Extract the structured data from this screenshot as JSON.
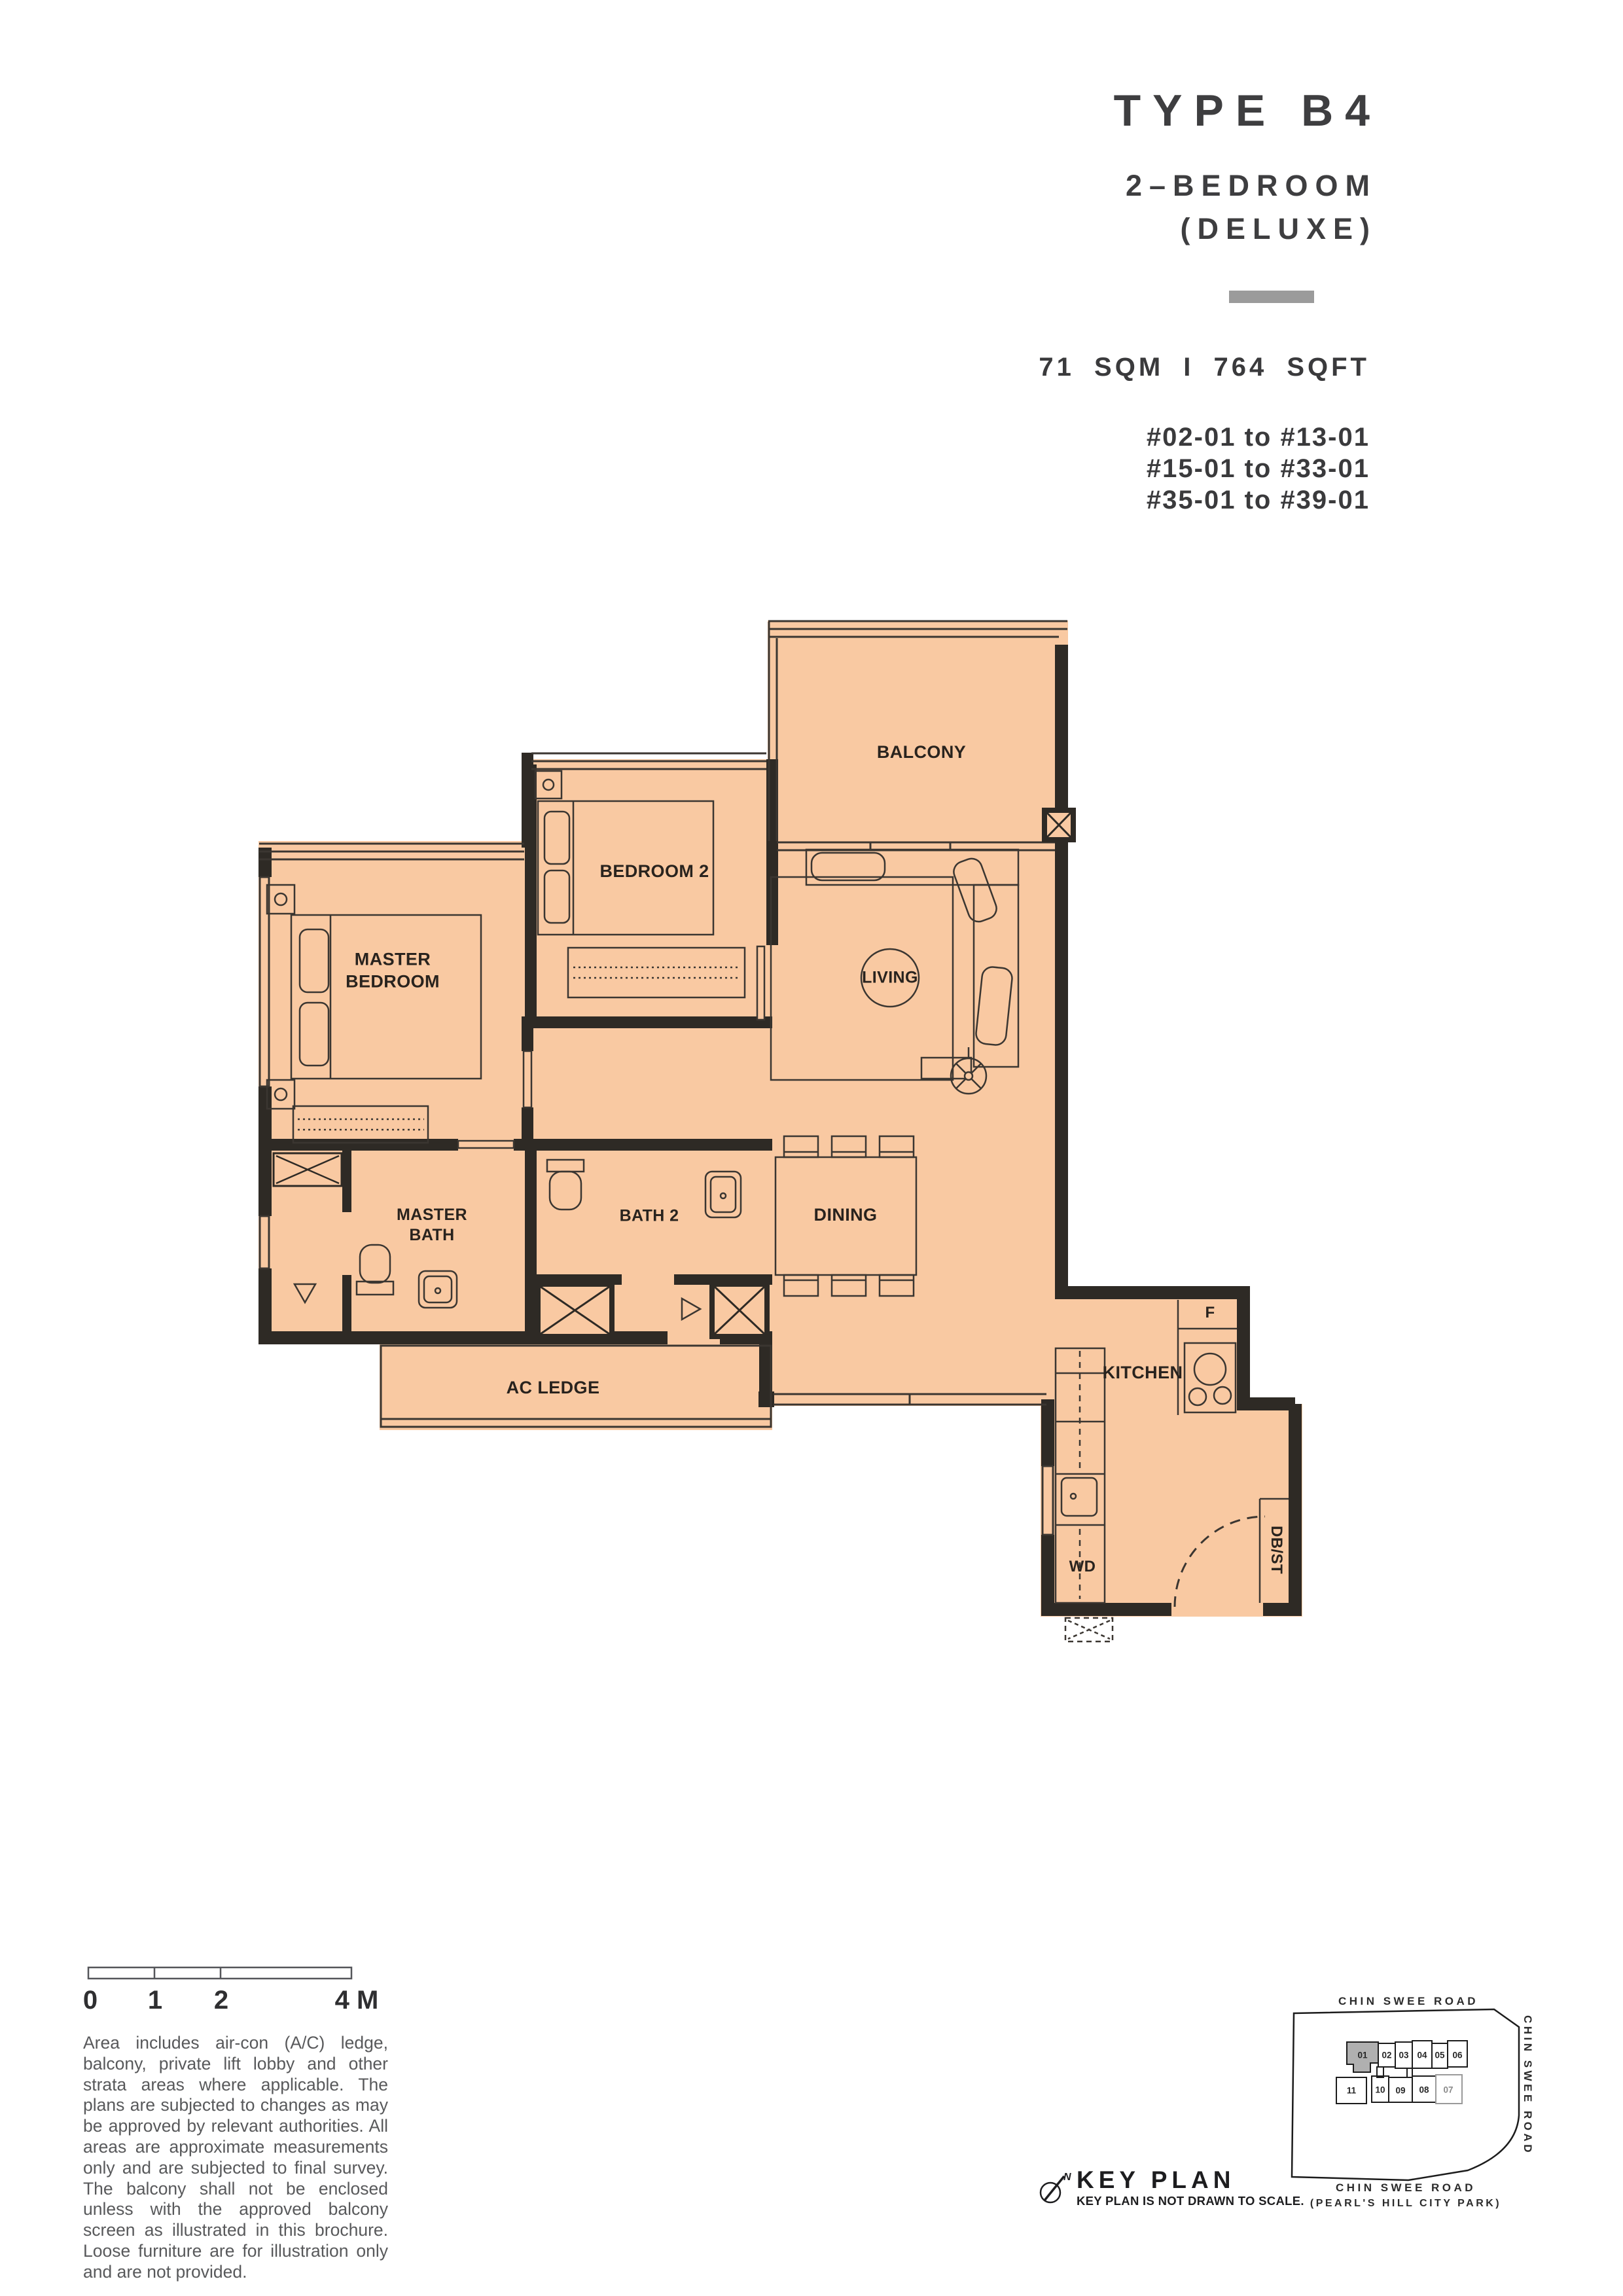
{
  "header": {
    "type_label": "TYPE B4",
    "bedroom_line": "2–BEDROOM",
    "deluxe_line": "(DELUXE)",
    "area_line": "71 SQM I 764 SQFT",
    "unit_lines": "#02-01 to #13-01\n#15-01 to #33-01\n#35-01 to #39-01",
    "accent_bar_color": "#9B9B9B"
  },
  "plan": {
    "fill_color": "#F9C9A2",
    "wall_color": "#2E2A25",
    "labels": {
      "balcony": "BALCONY",
      "bedroom2": "BEDROOM 2",
      "master_bedroom": "MASTER\nBEDROOM",
      "living": "LIVING",
      "dining": "DINING",
      "master_bath": "MASTER\nBATH",
      "bath2": "BATH 2",
      "ac_ledge": "AC LEDGE",
      "kitchen": "KITCHEN",
      "fridge": "F",
      "washer_dryer": "WD",
      "db_st": "DB/ST"
    }
  },
  "scalebar": {
    "tick0": "0",
    "tick1": "1",
    "tick2": "2",
    "tick4": "4 M"
  },
  "disclaimer": "Area includes air-con (A/C) ledge, balcony, private lift lobby and other strata areas where applicable. The plans are subjected to changes as may be approved by relevant authorities. All areas are approximate measurements only and are subjected to final survey. The balcony shall not be enclosed unless with the approved balcony screen as illustrated in this brochure. Loose furniture are for illustration only and are not provided.",
  "keyplan": {
    "title": "KEY PLAN",
    "subtitle": "KEY PLAN IS NOT DRAWN TO SCALE.",
    "compass_n": "N",
    "road_top": "CHIN SWEE ROAD",
    "road_right": "CHIN SWEE ROAD",
    "road_bottom_1": "CHIN SWEE ROAD",
    "road_bottom_2": "(PEARL'S HILL CITY PARK)",
    "stacks_top": [
      "01",
      "02",
      "03",
      "04",
      "05",
      "06"
    ],
    "stacks_bottom": [
      "11",
      "10",
      "09",
      "08",
      "07"
    ]
  }
}
